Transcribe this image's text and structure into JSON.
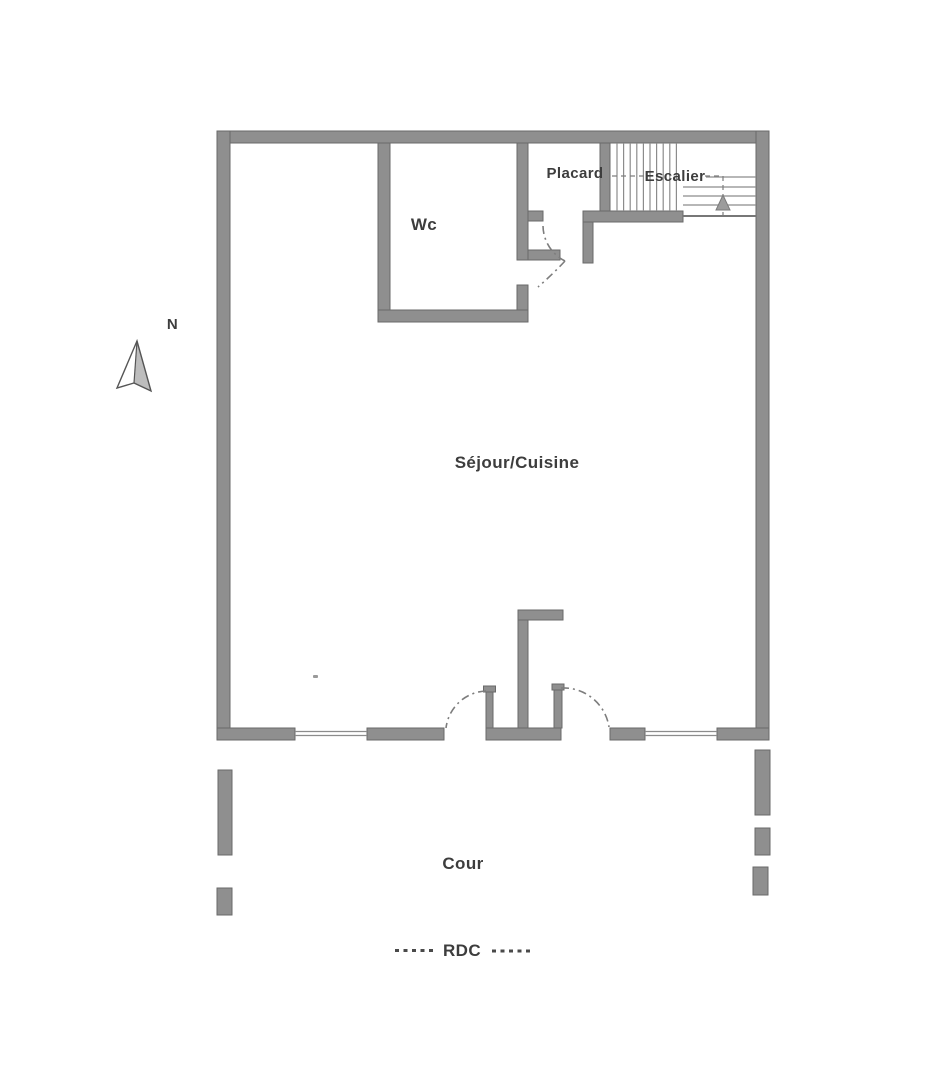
{
  "labels": {
    "wc": "Wc",
    "placard": "Placard",
    "escalier": "Escalier",
    "sejour_cuisine": "Séjour/Cuisine",
    "cour": "Cour",
    "floor": "RDC",
    "north": "N"
  },
  "colors": {
    "background": "#ffffff",
    "wall_fill": "#8f8f8f",
    "wall_edge": "#6a6a6a",
    "thin_line": "#8c8c8c",
    "dash_line": "#7d7d7d",
    "label_text": "#3d3d3d",
    "arrow_fill": "#9c9c9c"
  }
}
